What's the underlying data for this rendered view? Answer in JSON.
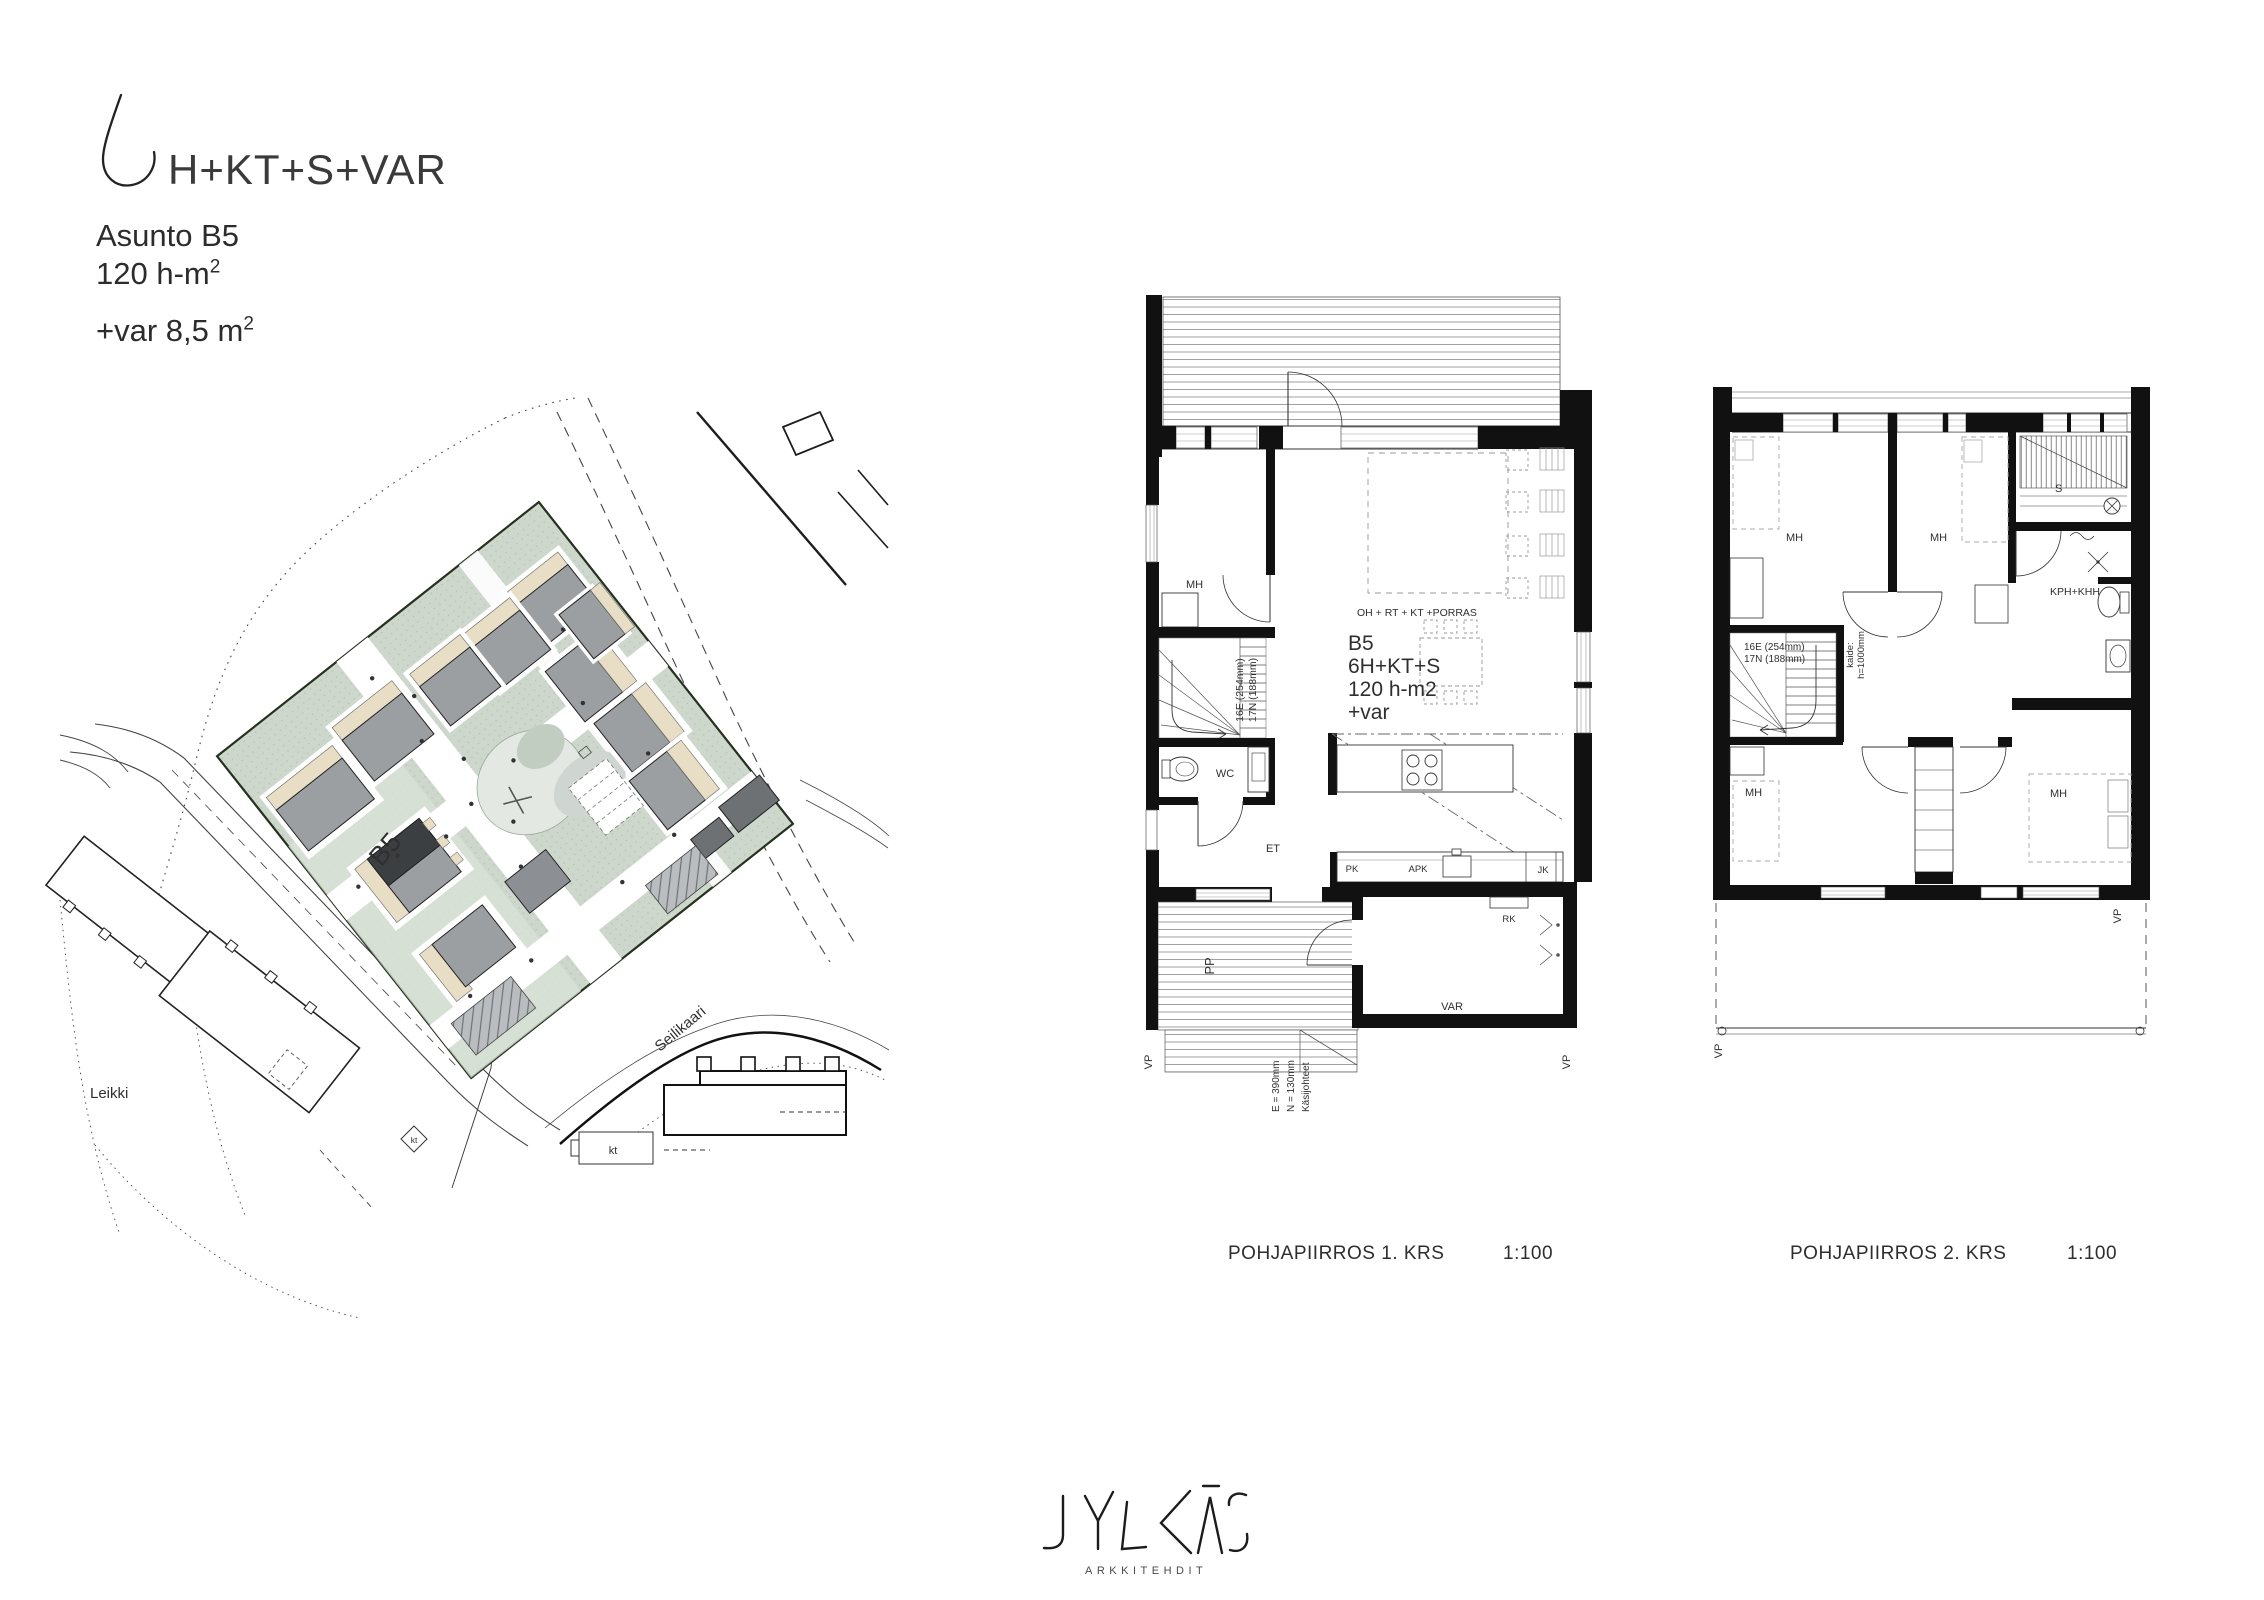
{
  "header": {
    "unit_count_glyph": "6",
    "title": "H+KT+S+VAR",
    "apartment": "Asunto B5",
    "area": "120 h-m",
    "area_sup": "2",
    "extra": "+var 8,5 m",
    "extra_sup": "2"
  },
  "site_plan": {
    "building_label": "B5",
    "leikki_label": "Leikki",
    "street_label": "Seilikaari",
    "kt1": "kt",
    "kt2": "kt",
    "colors": {
      "site_green": "#cdd7cb",
      "building_gray": "#9b9fa2",
      "building_dark": "#3c3f41",
      "patio_beige": "#e8dec5"
    }
  },
  "plan1": {
    "caption": "POHJAPIIRROS 1. KRS",
    "scale": "1:100",
    "room_mh": "MH",
    "room_wc": "WC",
    "room_et": "ET",
    "room_oh": "OH + RT + KT +PORRAS",
    "unit": "B5",
    "unit_rooms": "6H+KT+S",
    "unit_area": "120 h-m2",
    "unit_var": "+var",
    "stair_e": "16E (254mm)",
    "stair_n": "17N (188mm)",
    "appl_pk": "PK",
    "appl_apk": "APK",
    "appl_jk": "JK",
    "appl_rk": "RK",
    "room_var": "VAR",
    "room_pp": "PP",
    "vp_left": "VP",
    "vp_right": "VP",
    "porch_e": "E = 390mm",
    "porch_n": "N = 130mm",
    "porch_rail": "Käsijohteet"
  },
  "plan2": {
    "caption": "POHJAPIIRROS 2. KRS",
    "scale": "1:100",
    "room_mh1": "MH",
    "room_mh2": "MH",
    "room_mh3": "MH",
    "room_mh4": "MH",
    "room_s": "S",
    "room_kph": "KPH+KHH",
    "stair_e": "16E (254mm)",
    "stair_n": "17N (188mm)",
    "kaide1": "kaide:",
    "kaide2": "h=1000mm",
    "vp_left": "VP",
    "vp_right": "VP"
  },
  "footer": {
    "logo": "JYLKÄS",
    "logo_sub": "ARKKITEHDIT"
  }
}
